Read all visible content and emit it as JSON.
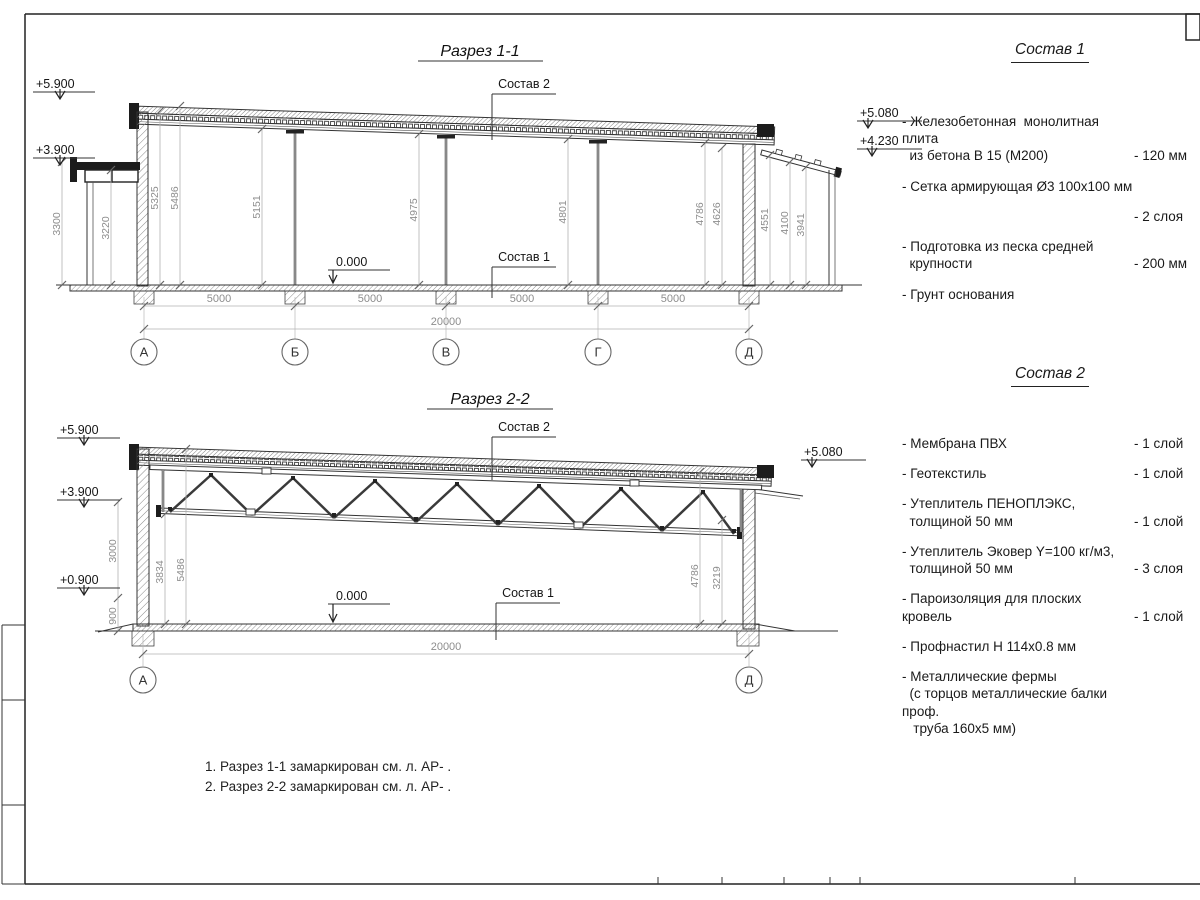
{
  "section1": {
    "title": "Разрез 1-1",
    "callout_roof": "Состав 2",
    "callout_floor": "Состав 1",
    "zero": "0.000",
    "elev_left_top": "+5.900",
    "elev_left_mid": "+3.900",
    "elev_right_top": "+5.080",
    "elev_right_mid": "+4.230",
    "vdims": [
      "3300",
      "3220",
      "5325",
      "5486",
      "5151",
      "4975",
      "4801",
      "4786",
      "4626",
      "4551",
      "4100",
      "3941"
    ],
    "hdims": [
      "5000",
      "5000",
      "5000",
      "5000"
    ],
    "total": "20000",
    "axes": [
      "А",
      "Б",
      "В",
      "Г",
      "Д"
    ]
  },
  "section2": {
    "title": "Разрез 2-2",
    "callout_roof": "Состав 2",
    "callout_floor": "Состав 1",
    "zero": "0.000",
    "elev_left_top": "+5.900",
    "elev_left_mid": "+3.900",
    "elev_left_low": "+0.900",
    "elev_right_top": "+5.080",
    "vdims": [
      "3000",
      "900",
      "3834",
      "5486",
      "4786",
      "3219"
    ],
    "total": "20000",
    "axes": [
      "А",
      "Д"
    ]
  },
  "comp1": {
    "title": "Состав 1",
    "items": [
      {
        "name": "- Железобетонная  монолитная плита\n  из бетона В 15 (М200)",
        "value": "- 120 мм"
      },
      {
        "name": "- Сетка армирующая Ø3 100х100 мм",
        "value": ""
      },
      {
        "name": "- Пленка полиэтиленовая",
        "value": "- 2 слоя"
      },
      {
        "name": "- Подготовка из песка средней\n  крупности",
        "value": "- 200 мм"
      },
      {
        "name": "- Грунт основания",
        "value": ""
      }
    ]
  },
  "comp2": {
    "title": "Состав 2",
    "items": [
      {
        "name": "- Мембрана ПВХ",
        "value": "- 1 слой"
      },
      {
        "name": "- Геотекстиль",
        "value": "- 1 слой"
      },
      {
        "name": "- Утеплитель ПЕНОПЛЭКС,\n  толщиной 50 мм",
        "value": "- 1 слой"
      },
      {
        "name": "- Утеплитель Эковер Y=100 кг/м3,\n  толщиной 50 мм",
        "value": "- 3 слоя"
      },
      {
        "name": "- Пароизоляция для плоских кровель",
        "value": "- 1 слой"
      },
      {
        "name": "- Профнастил Н 114х0.8 мм",
        "value": ""
      },
      {
        "name": "- Металлические фермы\n  (с торцов металлические балки проф.\n   труба 160х5 мм)",
        "value": ""
      }
    ]
  },
  "notes": [
    "1. Разрез 1-1 замаркирован см. л. АР- .",
    "2. Разрез 2-2 замаркирован см. л. АР- ."
  ]
}
